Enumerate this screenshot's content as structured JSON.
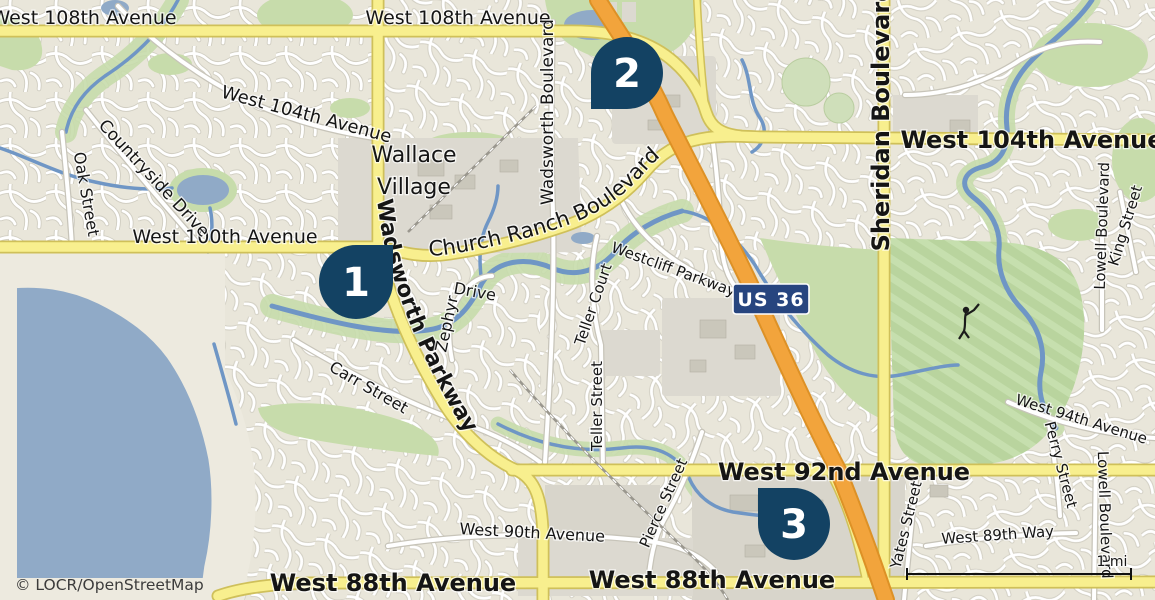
{
  "attribution": "© LOCR/OpenStreetMap",
  "scale": {
    "label": "1 mi"
  },
  "place": {
    "name_line1": "Wallace",
    "name_line2": "Village"
  },
  "shield": {
    "label": "US 36"
  },
  "markers": {
    "m1": "1",
    "m2": "2",
    "m3": "3"
  },
  "roads": {
    "west_108th": "West 108th Avenue",
    "west_104th": "West 104th Avenue",
    "sheridan": "Sheridan Boulevard",
    "wadsworth_blvd": "Wadsworth Boulevard",
    "wadsworth_pkwy": "Wadsworth Parkway",
    "church_ranch": "Church Ranch Boulevard",
    "west_100th": "West 100th Avenue",
    "countryside": "Countryside Drive",
    "oak": "Oak Street",
    "carr": "Carr Street",
    "zephyr_word": "Zephyr",
    "drive_word": "Drive",
    "westcliff": "Westcliff Parkway",
    "teller_court": "Teller Court",
    "teller_street": "Teller Street",
    "pierce": "Pierce Street",
    "west_90th": "West 90th Avenue",
    "west_92nd": "West 92nd Avenue",
    "west_88th": "West 88th Avenue",
    "yates": "Yates Street",
    "west_89th_way": "West 89th Way",
    "perry": "Perry Street",
    "lowell": "Lowell Boulevard",
    "king": "King Street",
    "west_94th": "West 94th Avenue"
  },
  "colors": {
    "marker": "#134263",
    "marker_text": "#ffffff",
    "shield_bg": "#27457f",
    "water": "#90aac7",
    "stream": "#6f96c5",
    "park": "#c7dcab",
    "golf": "#b9d49e",
    "road_major_fill": "#f8ef8e",
    "road_major_casing": "#cfc05a",
    "highway_fill": "#f2a43c",
    "highway_casing": "#dd9126",
    "land": "#edeadf",
    "urban": "#dcd9d0",
    "label": "#151515"
  }
}
